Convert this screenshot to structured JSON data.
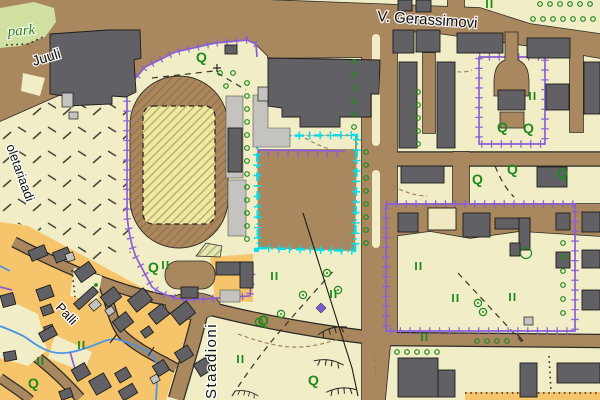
{
  "map": {
    "labels": {
      "gerassimovi": "V. Gerassimovi",
      "juuli": "Juuli",
      "palli": "Palli",
      "staadioni": "Staadioni",
      "left_street": "oletariaadi",
      "park": "park"
    },
    "symbols": {
      "tree_glyph": "Q",
      "meadow_symbol_name": "grass-II-symbol",
      "tree_row_symbol_name": "tree-ring-symbol"
    },
    "colors": {
      "road": "#a9875f",
      "ground": "#f1edc6",
      "residential": "#f5c46b",
      "park": "#cfe0a0",
      "sports_field": "#ece9a2",
      "sports_green": "#dfe9b2",
      "building": "#616165",
      "building_light": "#c4c3bf",
      "foundation": "#efe9c2",
      "parcel_purple": "#8a5fd6",
      "parcel_cyan": "#00dfee",
      "water": "#4a95e8",
      "vegetation": "#1e8a1e",
      "casing": "#2b2b24",
      "contour": "#9b7a50",
      "label": "#111111"
    }
  }
}
